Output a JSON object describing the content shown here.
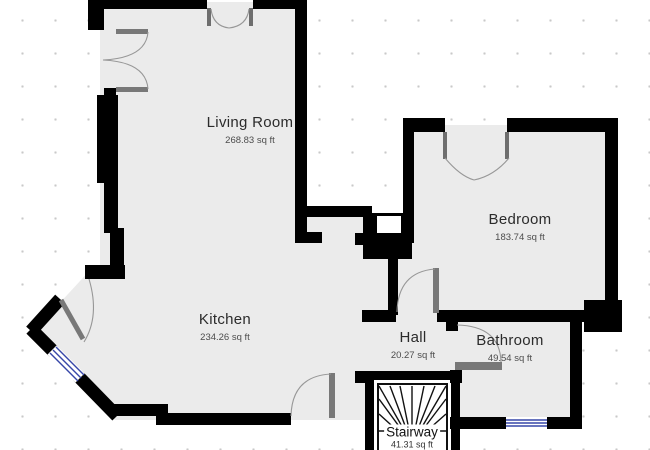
{
  "rooms": [
    {
      "name": "Living Room",
      "area": "268.83 sq ft"
    },
    {
      "name": "Kitchen",
      "area": "234.26 sq ft"
    },
    {
      "name": "Bedroom",
      "area": "183.74 sq ft"
    },
    {
      "name": "Hall",
      "area": "20.27 sq ft"
    },
    {
      "name": "Bathroom",
      "area": "49.54 sq ft"
    },
    {
      "name": "Stairway",
      "area": "41.31 sq ft"
    }
  ],
  "colors": {
    "wall": "#000000",
    "floor": "#ebebeb",
    "door_leaf": "#787878",
    "door_arc": "#979797",
    "window": "#3646a8",
    "grid_dot": "#c9c9c9",
    "background": "#ffffff"
  },
  "units": "sq ft"
}
